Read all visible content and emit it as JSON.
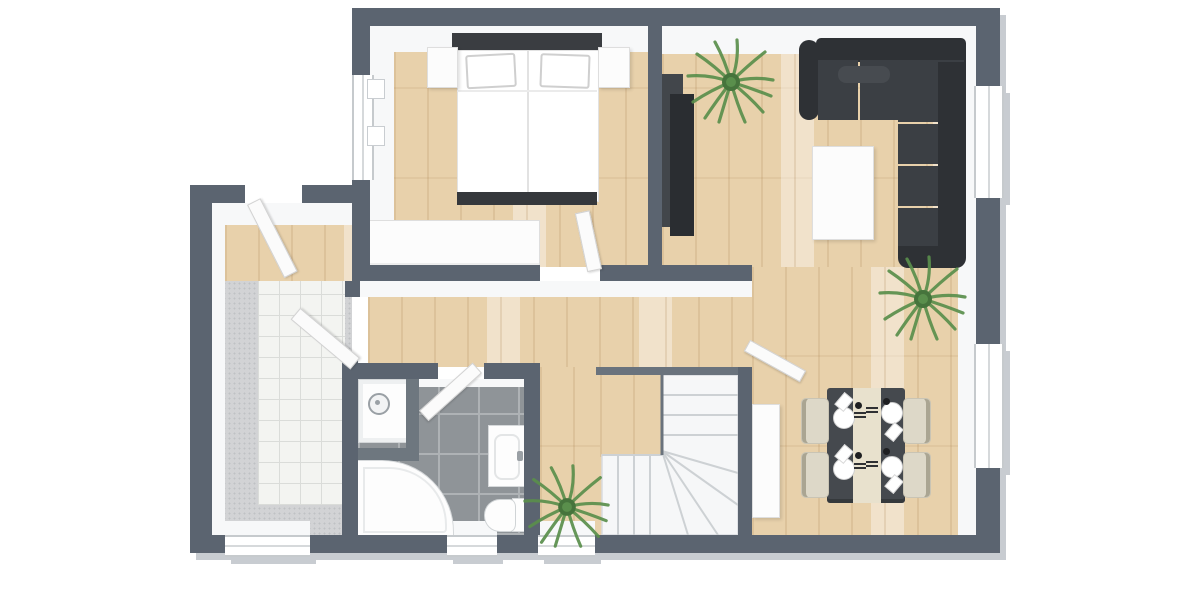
{
  "scene": {
    "description": "3D top-down floor plan render of an apartment, no text labels",
    "background": "#ffffff",
    "palette": {
      "wall": "#5b6470",
      "wallFace": "#f7f8f9",
      "wallEdge": "#c8ccd1",
      "wood": "#e8d1ab",
      "woodGrain": "rgba(167,124,75,0.18)",
      "bathTile": "#8f9498",
      "grout": "#aeb2b5",
      "carpet": "#d2d3d5",
      "speckle": "#bfc1c4",
      "tile": "#f3f4f1",
      "tileLine": "#dadcd9",
      "furn": "#fcfcfc",
      "furnEdge": "#dedede",
      "dark": "#34373b",
      "sofa": "#3b3f44",
      "sofaDark": "#2e3135",
      "sofaMid": "#474b50",
      "plant": "#5a8f4c",
      "plantDark": "#46743c",
      "chair": "#ddd8c8",
      "chairEdge": "#aaa592",
      "table": "#45494e",
      "runner": "#e8e1cd",
      "stairLine": "#cdd1d4",
      "stairEdge": "#6a737d"
    },
    "rooms": [
      {
        "id": "bedroom",
        "floor": "light-wood",
        "windows": 1,
        "furniture": [
          "double-bed",
          "pillow-left",
          "pillow-right",
          "nightstand-left",
          "nightstand-right",
          "wardrobe"
        ]
      },
      {
        "id": "living-dining-room",
        "floor": "light-wood",
        "windows": 2,
        "furniture": [
          "corner-sofa",
          "lounge-pillow",
          "coffee-table",
          "tv-cabinet",
          "dining-table",
          "dining-chairs-x4",
          "place-settings-x4",
          "sideboard",
          "potted-plant-x2"
        ]
      },
      {
        "id": "hallway",
        "floor": "light-wood",
        "windows": 1,
        "furniture": [
          "potted-plant"
        ]
      },
      {
        "id": "bathroom",
        "floor": "gray-tile",
        "windows": 1,
        "furniture": [
          "shower",
          "corner-bathtub",
          "washbasin-cabinet",
          "toilet"
        ]
      },
      {
        "id": "entry-hall",
        "floor": "white-tile-with-gray-mat",
        "windows": 1,
        "furniture": []
      },
      {
        "id": "staircase",
        "furniture": [
          "winder-stairs"
        ]
      }
    ],
    "counts": {
      "windows": 6,
      "door_leaves": 5,
      "plants": 3,
      "dining_seats": 4
    }
  }
}
